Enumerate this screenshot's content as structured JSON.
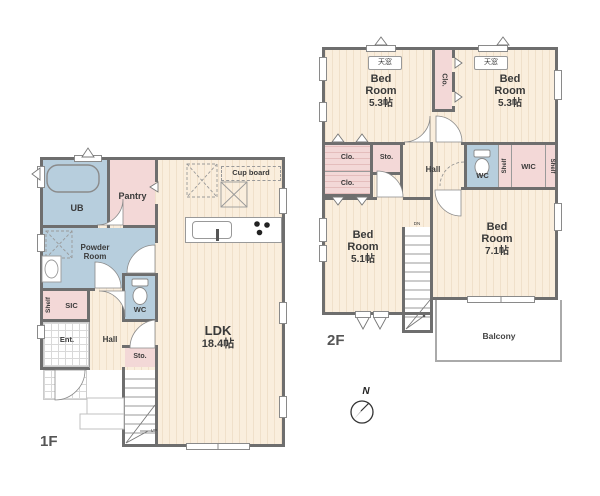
{
  "colors": {
    "floor_cream": "#faeedd",
    "closet_pink": "#f3d8d7",
    "wet_area_blue": "#b7cedd",
    "wall_gray": "#6e6e6e"
  },
  "floor1": {
    "label": "1F",
    "ub": "UB",
    "pantry": "Pantry",
    "powder_l1": "Powder",
    "powder_l2": "Room",
    "shelf": "Shelf",
    "sic": "SIC",
    "wc": "WC",
    "ent": "Ent.",
    "hall": "Hall",
    "sto": "Sto.",
    "ldk": "LDK",
    "ldk_size": "18.4帖",
    "cupboard": "Cup board",
    "up": "UP"
  },
  "floor2": {
    "label": "2F",
    "bed1": {
      "l1": "Bed",
      "l2": "Room",
      "size": "5.3帖"
    },
    "bed2": {
      "l1": "Bed",
      "l2": "Room",
      "size": "5.3帖"
    },
    "bed3": {
      "l1": "Bed",
      "l2": "Room",
      "size": "5.1帖"
    },
    "bed4": {
      "l1": "Bed",
      "l2": "Room",
      "size": "7.1帖"
    },
    "skylight1": "天窓",
    "skylight2": "天窓",
    "clo_mid": "Clo.",
    "clo1": "Clo.",
    "clo2": "Clo.",
    "sto": "Sto.",
    "hall": "Hall",
    "wc": "WC",
    "shelf_left": "Shelf",
    "wic": "WIC",
    "shelf_right": "Shelf",
    "balcony": "Balcony",
    "dn": "DN"
  },
  "compass": {
    "north": "N"
  }
}
